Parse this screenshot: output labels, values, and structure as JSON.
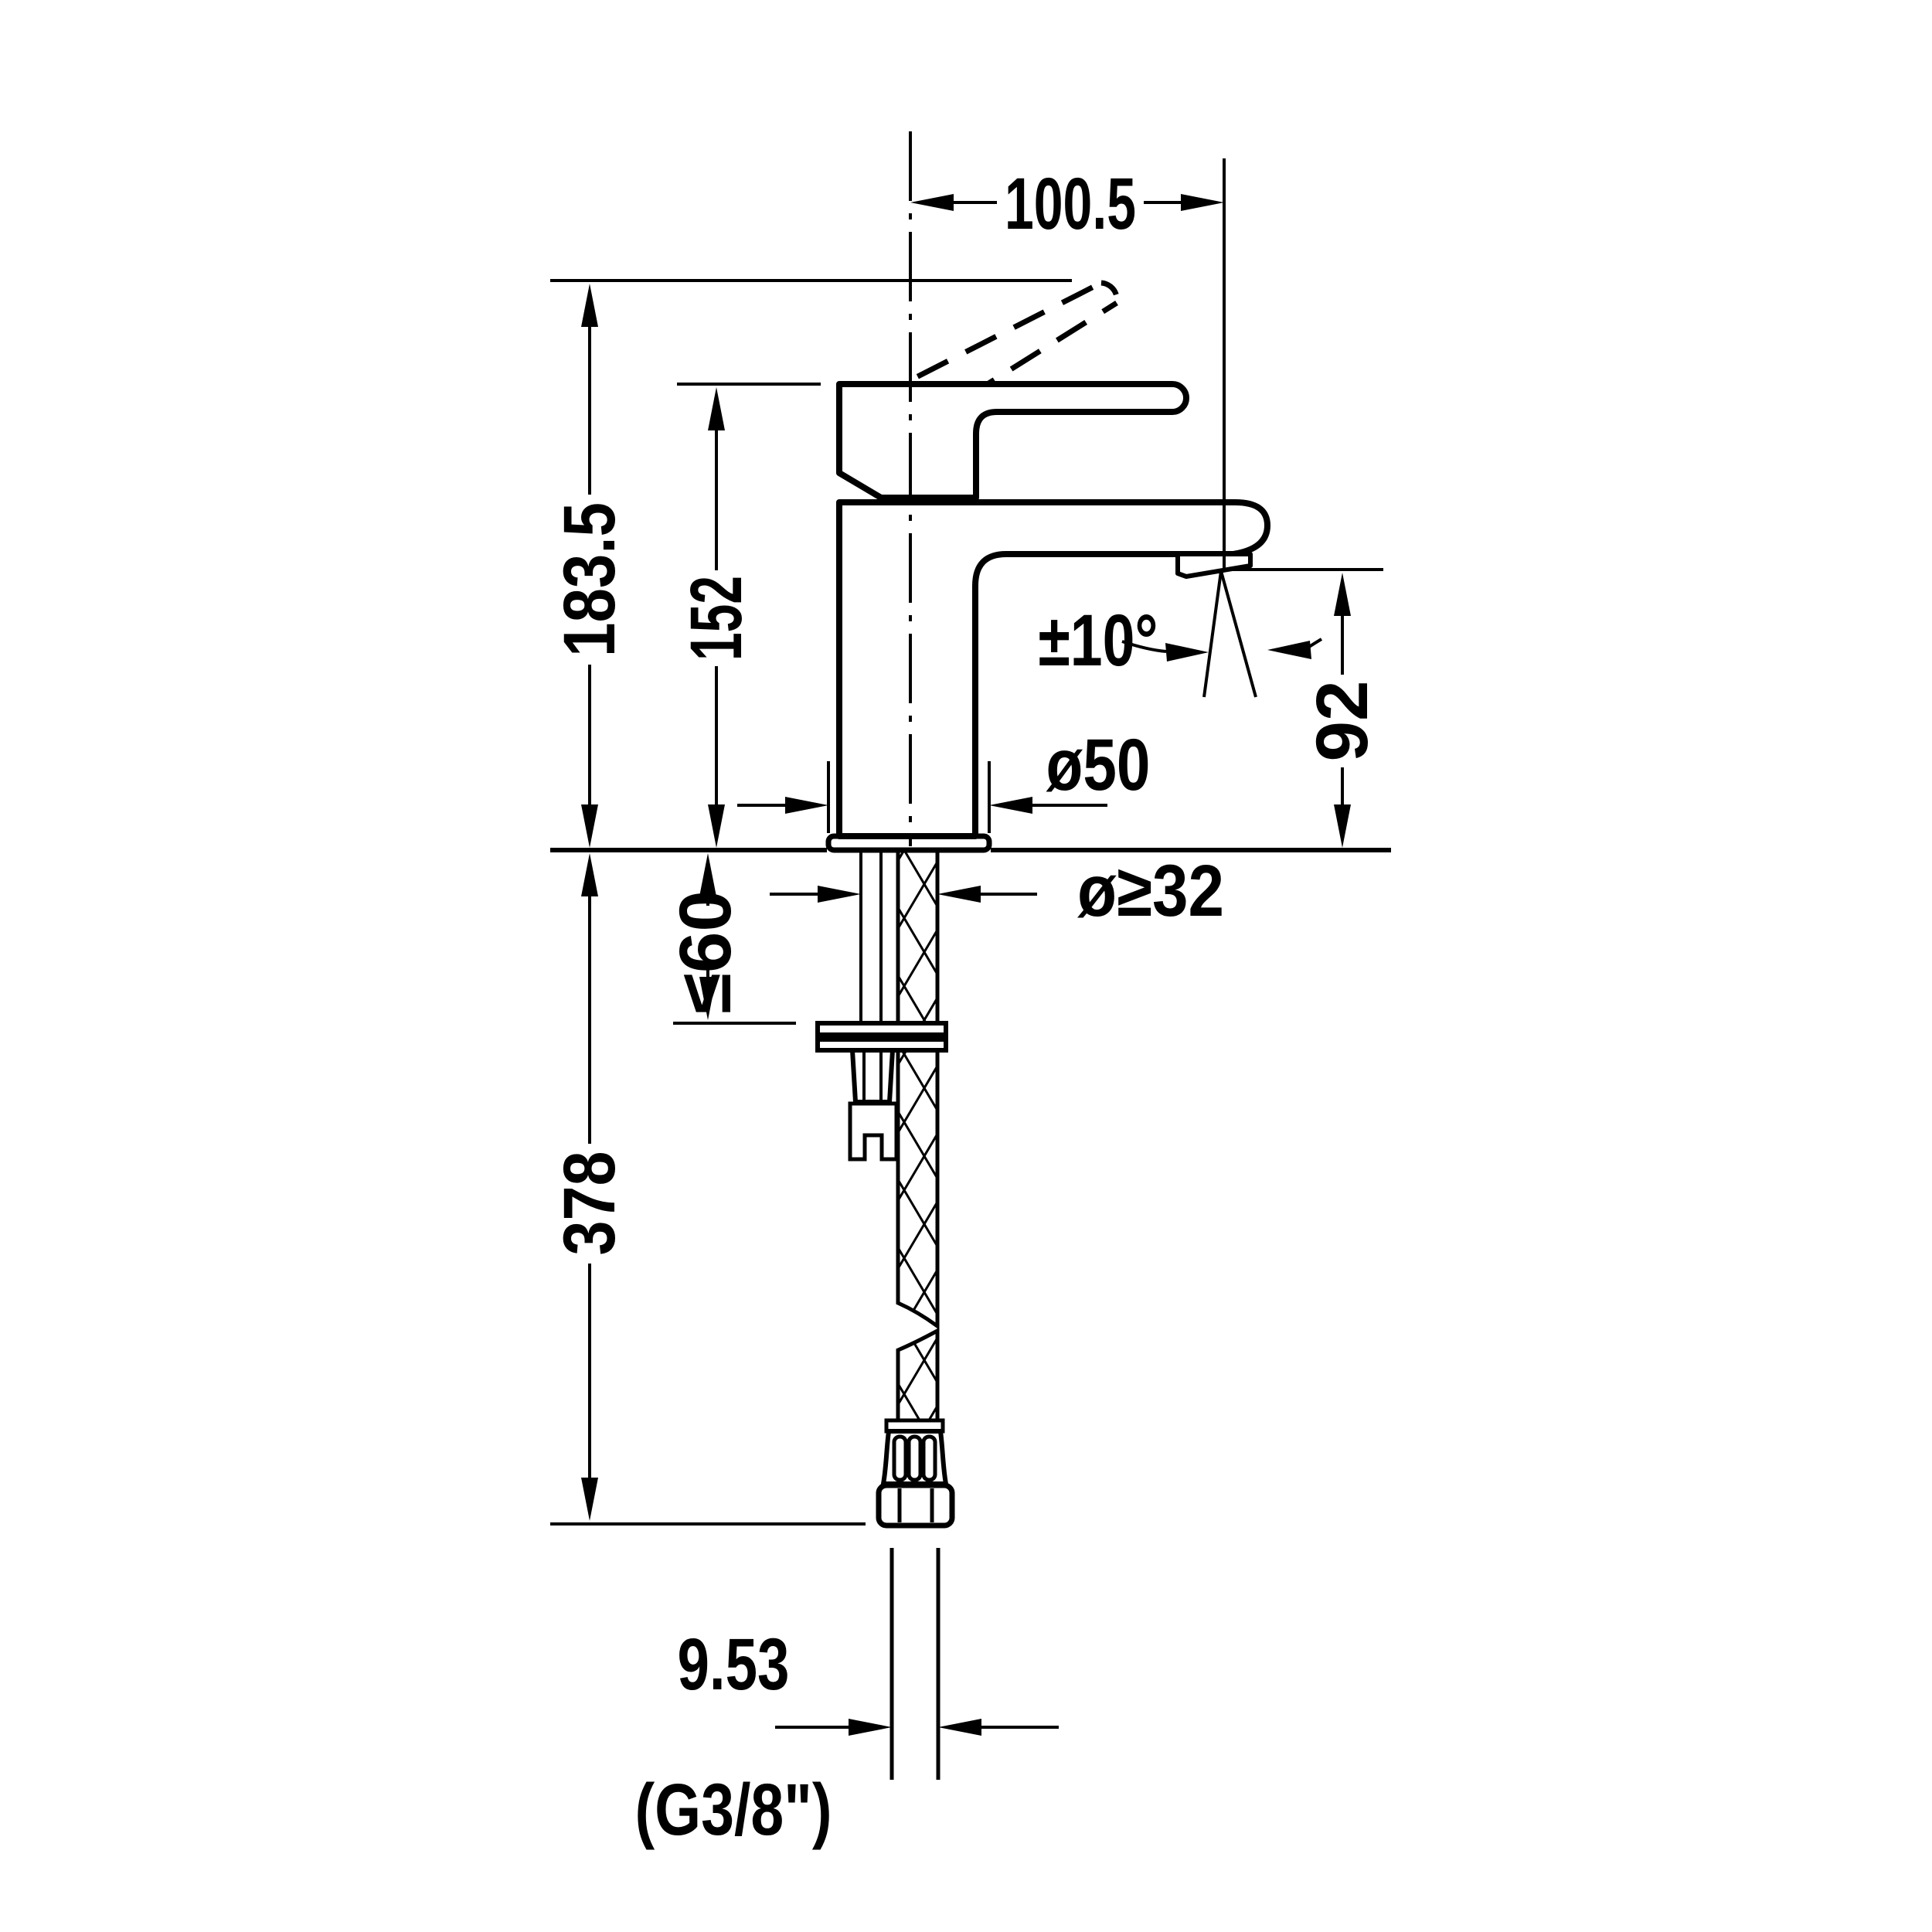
{
  "page": {
    "background_color": "#ffffff",
    "line_color": "#000000",
    "text_color": "#000000",
    "drawing_type": "faucet-installation-dimension-drawing"
  },
  "dimensions": {
    "spout_reach": "100.5",
    "overall_height": "183.5",
    "height_to_handle": "152",
    "swivel_angle": "±10°",
    "spout_outlet_height": "92",
    "base_diameter": "ø50",
    "min_hole_diameter": "ø≥32",
    "max_deck_thickness": "≤60",
    "below_deck_length": "378",
    "connector_diameter": "9.53",
    "thread_designation": "(G3/8\")"
  }
}
